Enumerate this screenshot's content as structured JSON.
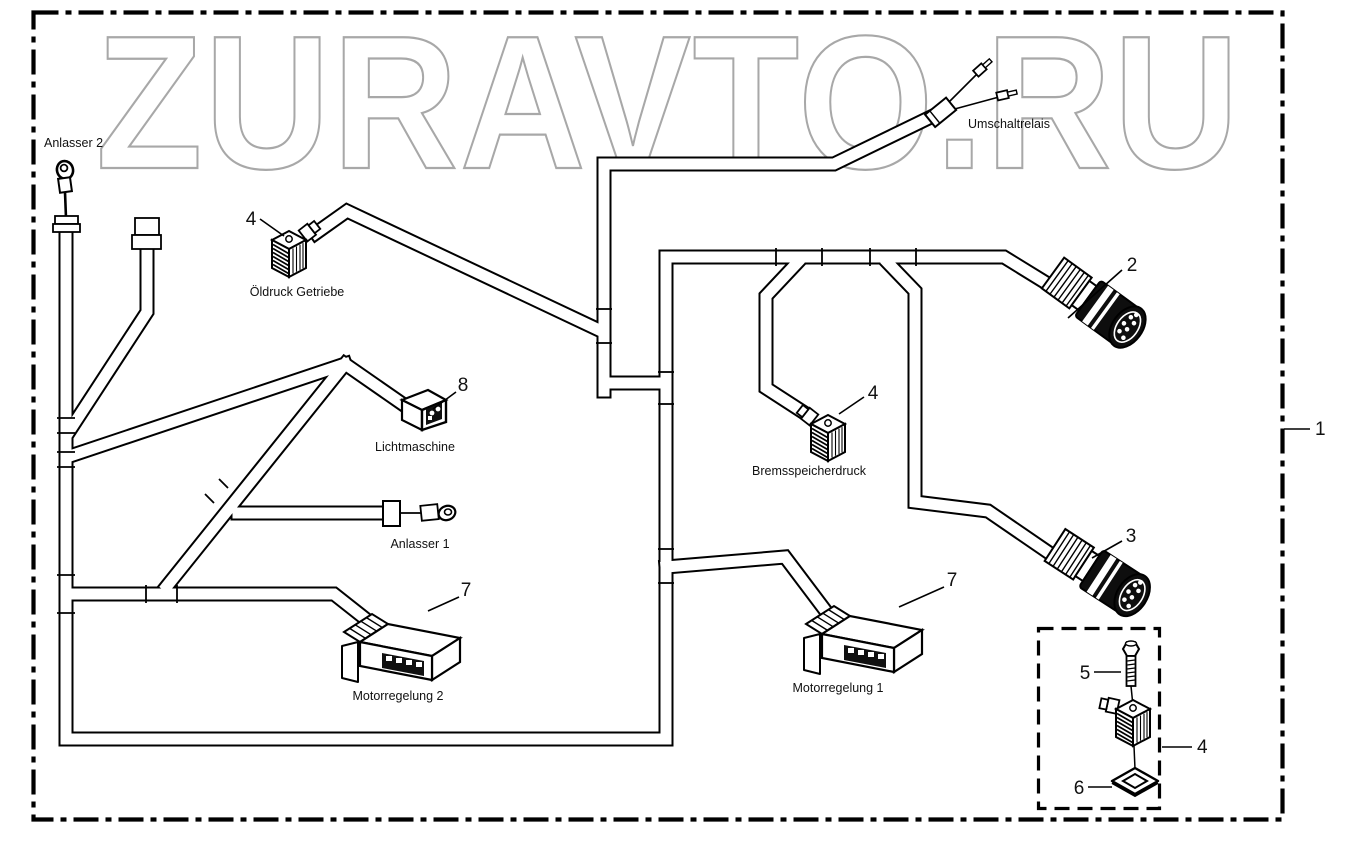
{
  "watermark": "ZURAVTO.RU",
  "colors": {
    "line": "#000000",
    "watermark": "#a8a8a8",
    "label": "#111111",
    "background": "#ffffff"
  },
  "callouts": {
    "harness": "1",
    "connector_round_upper": "2",
    "connector_round_lower": "3",
    "valve_connector_oeldruck": "4",
    "valve_connector_brems": "4",
    "valve_connector_kit": "4",
    "screw": "5",
    "seal": "6",
    "motorregelung2_connector": "7",
    "motorregelung1_connector": "7",
    "lichtmaschine_connector": "8"
  },
  "labels": {
    "anlasser2": "Anlasser 2",
    "oeldruck_getriebe": "Öldruck Getriebe",
    "lichtmaschine": "Lichtmaschine",
    "anlasser1": "Anlasser 1",
    "motorregelung2": "Motorregelung 2",
    "motorregelung1": "Motorregelung 1",
    "bremsspeicherdruck": "Bremsspeicherdruck",
    "umschaltrelais": "Umschaltrelais"
  }
}
